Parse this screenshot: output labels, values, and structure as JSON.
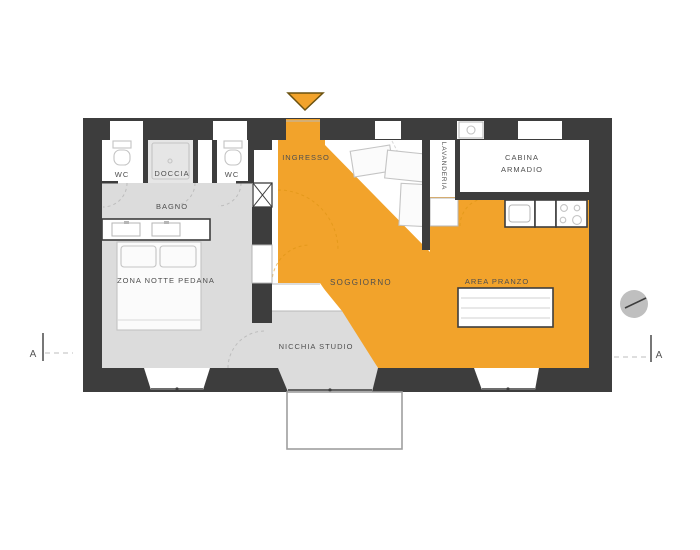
{
  "colors": {
    "highlight_orange": "#F2A32B",
    "wall_dark": "#3D3D3D",
    "floor_gray": "#DCDCDC",
    "shower_gray": "#E6E6E6",
    "label_gray": "#4F4F4F",
    "sketch_gray": "#C4C4C4",
    "arrow_border": "#6B5210",
    "marker_gray": "#BFBFBF"
  },
  "rooms": {
    "wc_left": "WC",
    "doccia": "DOCCIA",
    "wc_right": "WC",
    "bagno": "BAGNO",
    "zona_notte": "ZONA NOTTE PEDANA",
    "ingresso": "INGRESSO",
    "soggiorno": "SOGGIORNO",
    "nicchia_studio": "NICCHIA STUDIO",
    "lavanderia": "LAVANDERIA",
    "cabina_armadio_line1": "CABINA",
    "cabina_armadio_line2": "ARMADIO",
    "area_pranzo": "AREA PRANZO"
  },
  "markers": {
    "section_left": "A",
    "section_right": "A"
  }
}
